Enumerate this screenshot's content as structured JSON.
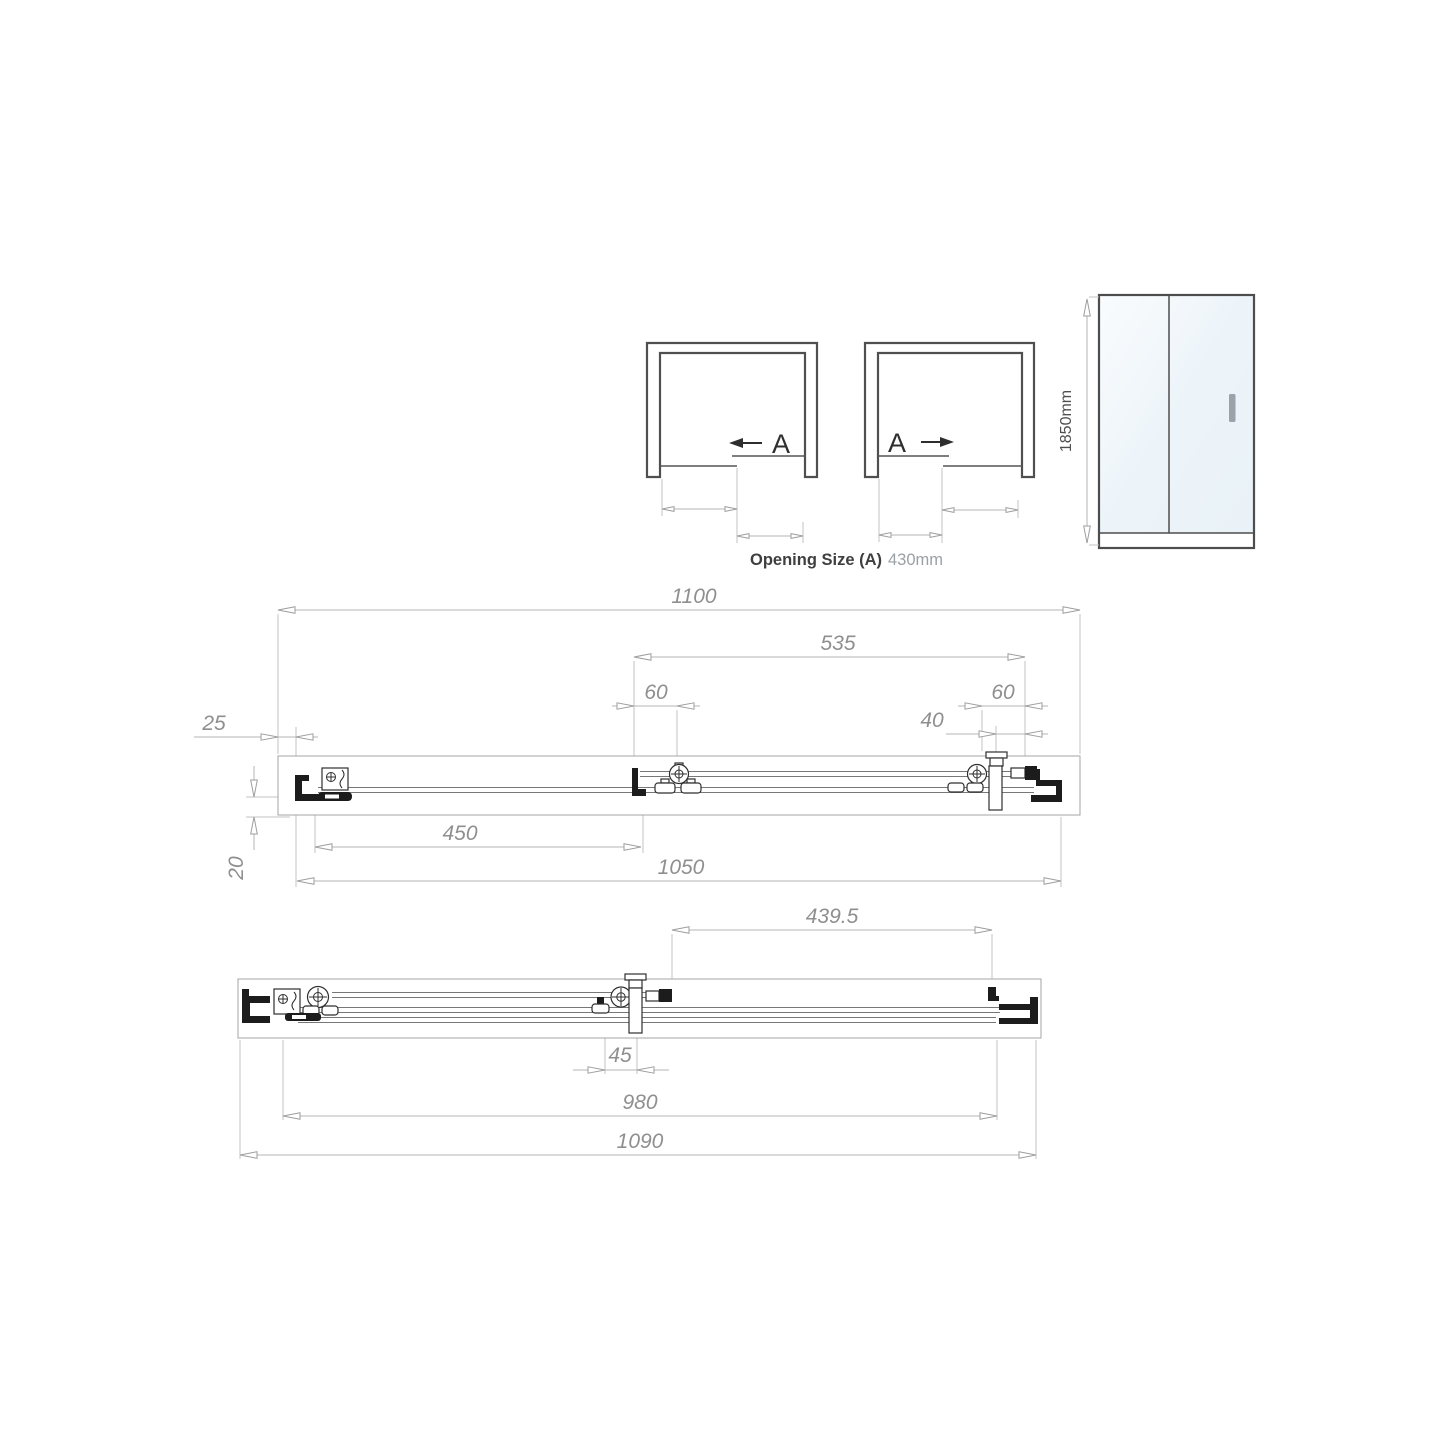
{
  "slide_diagrams": {
    "left": {
      "label": "A"
    },
    "right": {
      "label": "A"
    }
  },
  "caption": {
    "label": "Opening Size (A)",
    "value": "430mm"
  },
  "front_elevation": {
    "height_label": "1850mm"
  },
  "plan_section_a": {
    "overall_frame_width": "1100",
    "sliding_panel_width": "535",
    "left_roller_spacing": "60",
    "right_roller_spacing": "60",
    "handle_to_frame": "40",
    "wall_profile_gap": "25",
    "fixed_panel_width": "450",
    "adjusted_width": "1050",
    "profile_depth": "20"
  },
  "plan_section_b": {
    "sliding_panel_offset": "439.5",
    "panel_overlap": "45",
    "glass_to_glass": "980",
    "minimum_width": "1090"
  },
  "colors": {
    "glass": "#e9f2f8",
    "handle": "#9aa3ab",
    "hardware": "#1c1c1c",
    "dimension_line": "#b5b5b5",
    "dimension_text": "#8f8f8f"
  }
}
